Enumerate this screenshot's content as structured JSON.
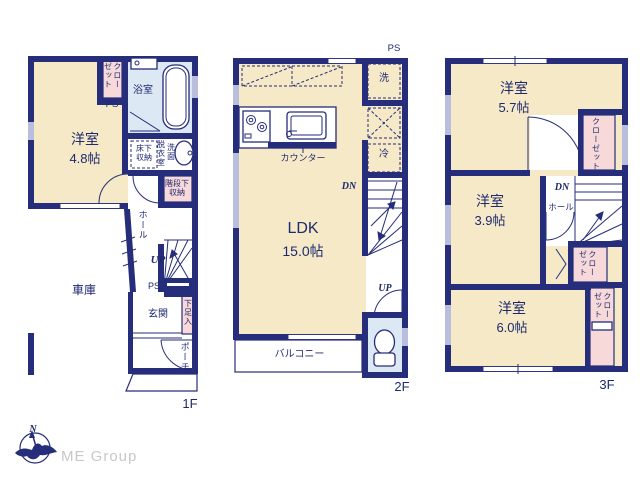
{
  "colors": {
    "wall_navy": "#262d7a",
    "room_cream": "#f5e9c8",
    "closet_pink": "#f8d9da",
    "wet_blue": "#dce9f4",
    "text_navy": "#1e2a6e",
    "logo_gray": "#c8c8c8"
  },
  "f1": {
    "label": "1F",
    "room": "洋室",
    "room_size": "4.8帖",
    "closet": "クローゼット",
    "ps_top": "PS",
    "bath": "浴室",
    "floor_storage": "床下\n収納",
    "dressing": "脱衣室",
    "vanity": "洗面",
    "stair_storage": "階段下\n収納",
    "hall": "ホール",
    "up": "UP",
    "ps_mid": "PS",
    "entry": "玄関",
    "shoe": "下足入",
    "porch": "ポーチ",
    "garage": "車庫"
  },
  "f2": {
    "label": "2F",
    "ps": "PS",
    "wash": "洗",
    "fridge": "冷",
    "counter": "カウンター",
    "ldk": "LDK",
    "ldk_size": "15.0帖",
    "dn": "DN",
    "up": "UP",
    "balcony": "バルコニー"
  },
  "f3": {
    "label": "3F",
    "room_a": "洋室",
    "room_a_size": "5.7帖",
    "closet_a": "クローゼット",
    "room_b": "洋室",
    "room_b_size": "3.9帖",
    "dn": "DN",
    "hall": "ホール",
    "closet_b": "クローゼット",
    "room_c": "洋室",
    "room_c_size": "6.0帖",
    "closet_c": "クローゼット"
  },
  "logo": {
    "north": "N",
    "company": "ME Group"
  }
}
